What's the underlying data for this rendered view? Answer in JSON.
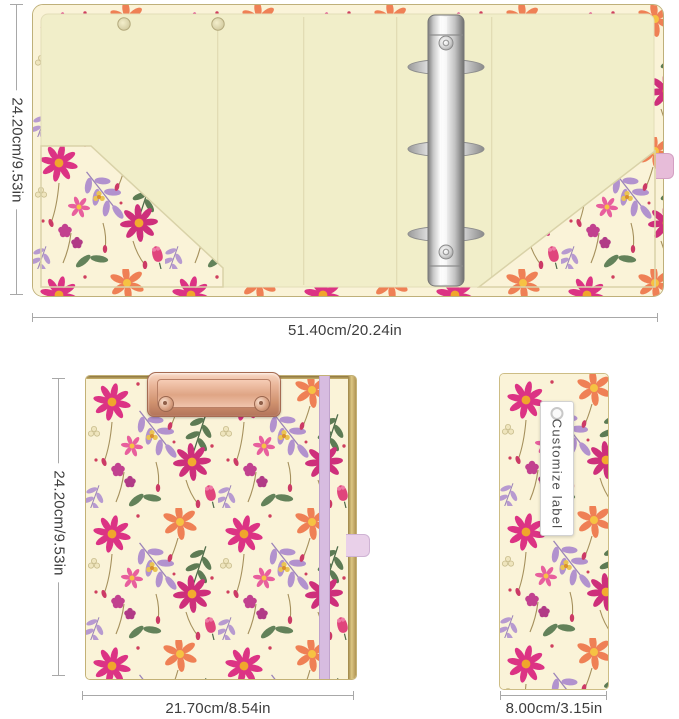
{
  "views": {
    "open": {
      "title": "open-binder-inside-view",
      "height_label": "24.20cm/9.53in",
      "width_label": "51.40cm/20.24in"
    },
    "front": {
      "title": "clipboard-front-view",
      "height_label": "24.20cm/9.53in",
      "width_label": "21.70cm/8.54in"
    },
    "spine": {
      "title": "spine-side-view",
      "width_label": "8.00cm/3.15in",
      "tag_text": "Customize label"
    }
  },
  "colors": {
    "background": "#ffffff",
    "interior_cream": "#f1eec9",
    "floral_cream": "#faf3d8",
    "hot_pink_flower": "#dc3384",
    "magenta_flower": "#ce2f7b",
    "coral_flower": "#ef8055",
    "purple_leaf": "#b292ce",
    "green_leaf": "#5d7b54",
    "berry_magenta": "#c2418f",
    "flower_center_orange": "#f0a62c",
    "rose_gold_clip": "#d0926f",
    "chrome_silver": "#d9d9d9",
    "lilac_band": "#d7bce0",
    "pink_ribbon": "#e7bcd9",
    "gold_trim": "#b09455",
    "dimension_line": "#a8a8a8",
    "dimension_text": "#3d3d3d"
  }
}
